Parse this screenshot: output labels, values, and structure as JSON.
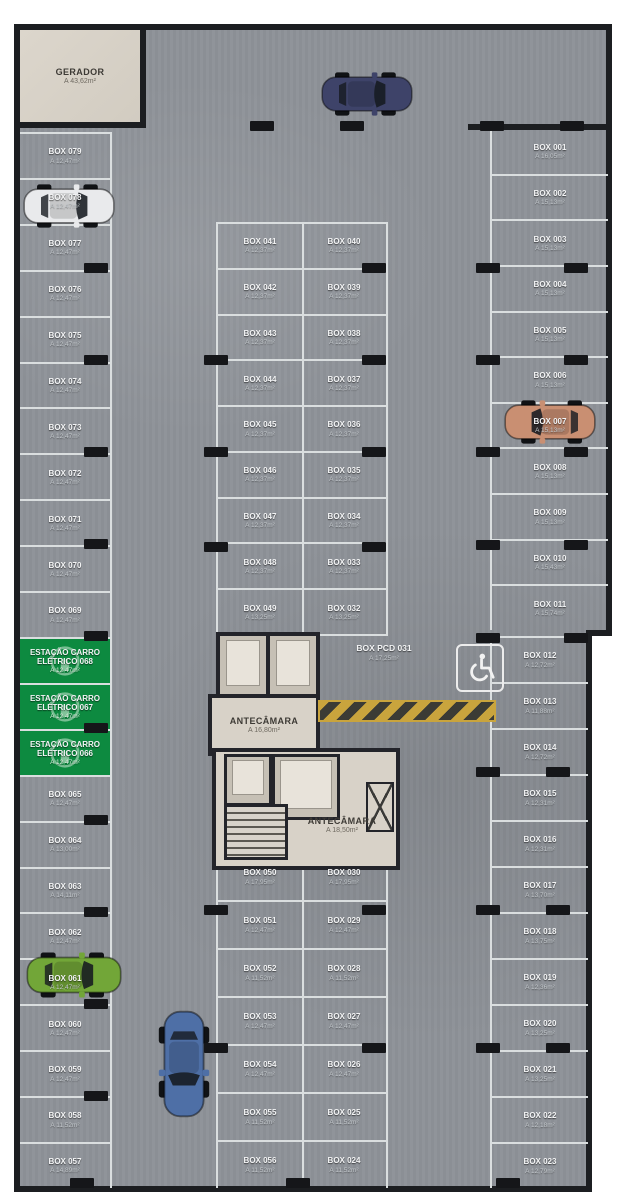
{
  "plan": {
    "gerador": {
      "label": "GERADOR",
      "area": "A 43,62m²"
    },
    "antecamara_up": {
      "label": "ANTECÂMARA",
      "area": "A 16,80m²"
    },
    "antecamara_lo": {
      "label": "ANTECÂMARA",
      "area": "A 18,50m²"
    },
    "box_pcd": {
      "label": "BOX PCD 031",
      "area": "A 17,25m²"
    }
  },
  "stalls": {
    "left": [
      {
        "label": "BOX 079",
        "area": "A 12,47m²"
      },
      {
        "label": "BOX 078",
        "area": "A 12,47m²"
      },
      {
        "label": "BOX 077",
        "area": "A 12,47m²"
      },
      {
        "label": "BOX 076",
        "area": "A 12,47m²"
      },
      {
        "label": "BOX 075",
        "area": "A 12,47m²"
      },
      {
        "label": "BOX 074",
        "area": "A 12,47m²"
      },
      {
        "label": "BOX 073",
        "area": "A 12,47m²"
      },
      {
        "label": "BOX 072",
        "area": "A 12,47m²"
      },
      {
        "label": "BOX 071",
        "area": "A 12,47m²"
      },
      {
        "label": "BOX 070",
        "area": "A 12,47m²"
      },
      {
        "label": "BOX 069",
        "area": "A 12,47m²"
      },
      {
        "label": "ESTAÇÃO CARRO ELÉTRICO 068",
        "area": "A 12,47m²",
        "type": "ev"
      },
      {
        "label": "ESTAÇÃO CARRO ELÉTRICO 067",
        "area": "A 12,47m²",
        "type": "ev"
      },
      {
        "label": "ESTAÇÃO CARRO ELÉTRICO 066",
        "area": "A 12,47m²",
        "type": "ev"
      },
      {
        "label": "BOX 065",
        "area": "A 12,47m²"
      },
      {
        "label": "BOX 064",
        "area": "A 13,00m²"
      },
      {
        "label": "BOX 063",
        "area": "A 14,11m²"
      },
      {
        "label": "BOX 062",
        "area": "A 12,47m²"
      },
      {
        "label": "BOX 061",
        "area": "A 12,47m²"
      },
      {
        "label": "BOX 060",
        "area": "A 12,47m²"
      },
      {
        "label": "BOX 059",
        "area": "A 12,47m²"
      },
      {
        "label": "BOX 058",
        "area": "A 11,52m²"
      },
      {
        "label": "BOX 057",
        "area": "A 14,89m²"
      }
    ],
    "mid_top_left": [
      {
        "label": "BOX 041",
        "area": "A 12,37m²"
      },
      {
        "label": "BOX 042",
        "area": "A 12,37m²"
      },
      {
        "label": "BOX 043",
        "area": "A 12,37m²"
      },
      {
        "label": "BOX 044",
        "area": "A 12,37m²"
      },
      {
        "label": "BOX 045",
        "area": "A 12,37m²"
      },
      {
        "label": "BOX 046",
        "area": "A 12,37m²"
      },
      {
        "label": "BOX 047",
        "area": "A 12,37m²"
      },
      {
        "label": "BOX 048",
        "area": "A 12,37m²"
      },
      {
        "label": "BOX 049",
        "area": "A 13,25m²"
      }
    ],
    "mid_top_right": [
      {
        "label": "BOX 040",
        "area": "A 12,37m²"
      },
      {
        "label": "BOX 039",
        "area": "A 12,37m²"
      },
      {
        "label": "BOX 038",
        "area": "A 12,37m²"
      },
      {
        "label": "BOX 037",
        "area": "A 12,37m²"
      },
      {
        "label": "BOX 036",
        "area": "A 12,37m²"
      },
      {
        "label": "BOX 035",
        "area": "A 12,37m²"
      },
      {
        "label": "BOX 034",
        "area": "A 12,37m²"
      },
      {
        "label": "BOX 033",
        "area": "A 12,37m²"
      },
      {
        "label": "BOX 032",
        "area": "A 13,25m²"
      }
    ],
    "mid_bottom_left": [
      {
        "label": "BOX 050",
        "area": "A 17,95m²"
      },
      {
        "label": "BOX 051",
        "area": "A 12,47m²"
      },
      {
        "label": "BOX 052",
        "area": "A 11,52m²"
      },
      {
        "label": "BOX 053",
        "area": "A 12,47m²"
      },
      {
        "label": "BOX 054",
        "area": "A 12,47m²"
      },
      {
        "label": "BOX 055",
        "area": "A 11,52m²"
      },
      {
        "label": "BOX 056",
        "area": "A 11,52m²"
      }
    ],
    "mid_bottom_right": [
      {
        "label": "BOX 030",
        "area": "A 17,95m²"
      },
      {
        "label": "BOX 029",
        "area": "A 12,47m²"
      },
      {
        "label": "BOX 028",
        "area": "A 11,52m²"
      },
      {
        "label": "BOX 027",
        "area": "A 12,47m²"
      },
      {
        "label": "BOX 026",
        "area": "A 12,47m²"
      },
      {
        "label": "BOX 025",
        "area": "A 11,52m²"
      },
      {
        "label": "BOX 024",
        "area": "A 11,52m²"
      }
    ],
    "right_upper": [
      {
        "label": "BOX 001",
        "area": "A 16,05m²"
      },
      {
        "label": "BOX 002",
        "area": "A 15,13m²"
      },
      {
        "label": "BOX 003",
        "area": "A 15,13m²"
      },
      {
        "label": "BOX 004",
        "area": "A 15,13m²"
      },
      {
        "label": "BOX 005",
        "area": "A 15,13m²"
      },
      {
        "label": "BOX 006",
        "area": "A 15,13m²"
      },
      {
        "label": "BOX 007",
        "area": "A 15,13m²"
      },
      {
        "label": "BOX 008",
        "area": "A 15,13m²"
      },
      {
        "label": "BOX 009",
        "area": "A 15,13m²"
      },
      {
        "label": "BOX 010",
        "area": "A 15,43m²"
      },
      {
        "label": "BOX 011",
        "area": "A 15,74m²"
      }
    ],
    "right_lower": [
      {
        "label": "BOX 012",
        "area": "A 12,72m²"
      },
      {
        "label": "BOX 013",
        "area": "A 11,88m²"
      },
      {
        "label": "BOX 014",
        "area": "A 12,72m²"
      },
      {
        "label": "BOX 015",
        "area": "A 12,31m²"
      },
      {
        "label": "BOX 016",
        "area": "A 12,31m²"
      },
      {
        "label": "BOX 017",
        "area": "A 13,70m²"
      },
      {
        "label": "BOX 018",
        "area": "A 13,75m²"
      },
      {
        "label": "BOX 019",
        "area": "A 12,36m²"
      },
      {
        "label": "BOX 020",
        "area": "A 13,25m²"
      },
      {
        "label": "BOX 021",
        "area": "A 13,25m²"
      },
      {
        "label": "BOX 022",
        "area": "A 12,18m²"
      },
      {
        "label": "BOX 023",
        "area": "A 12,79m²"
      }
    ]
  },
  "cars": [
    {
      "name": "white car",
      "color": "#e9eaec"
    },
    {
      "name": "navy car",
      "color": "#3e4369"
    },
    {
      "name": "copper car",
      "color": "#c98f72"
    },
    {
      "name": "green car",
      "color": "#72a638"
    },
    {
      "name": "blue car",
      "color": "#4e6fa6"
    }
  ],
  "colors": {
    "ev_station_green": "#0d8a40",
    "hatch_yellow": "#c9a43d",
    "floor_gray": "#8e9298",
    "wall_dark": "#1c1e21"
  }
}
